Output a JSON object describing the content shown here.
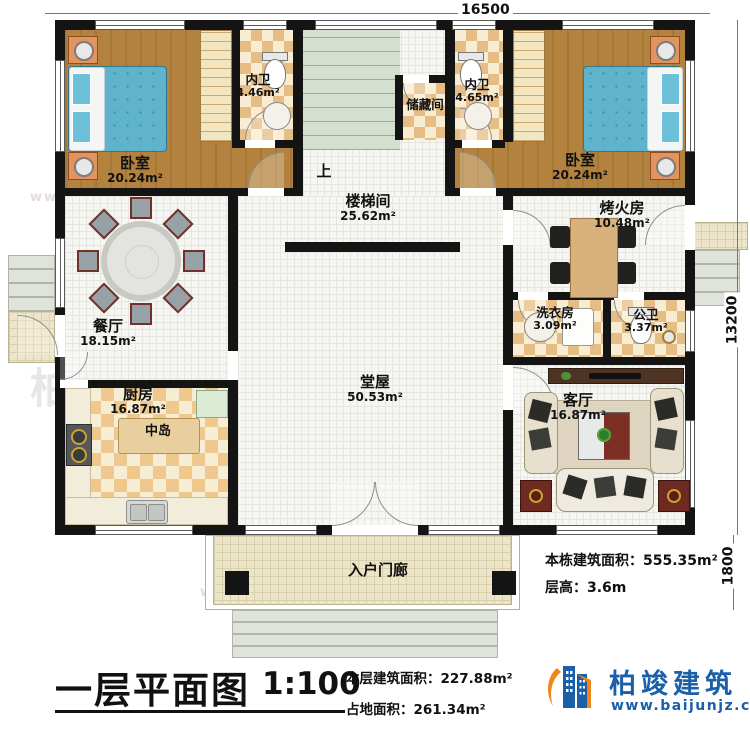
{
  "dimensions": {
    "top_width": "16500",
    "right_height": "13200",
    "porch_depth": "1800"
  },
  "rooms": [
    {
      "name": "卧室",
      "area": "20.24m²"
    },
    {
      "name": "内卫",
      "area": "4.46m²"
    },
    {
      "name": "储藏间",
      "area": ""
    },
    {
      "name": "楼梯间",
      "area": "25.62m²"
    },
    {
      "name": "内卫",
      "area": "4.65m²"
    },
    {
      "name": "卧室",
      "area": "20.24m²"
    },
    {
      "name": "餐厅",
      "area": "18.15m²"
    },
    {
      "name": "堂屋",
      "area": "50.53m²"
    },
    {
      "name": "烤火房",
      "area": "10.48m²"
    },
    {
      "name": "洗衣房",
      "area": "3.09m²"
    },
    {
      "name": "公卫",
      "area": "3.37m²"
    },
    {
      "name": "厨房",
      "area": "16.87m²"
    },
    {
      "name": "客厅",
      "area": "16.87m²"
    },
    {
      "name": "入户门廊",
      "area": ""
    }
  ],
  "labels": {
    "up": "上",
    "island": "中岛"
  },
  "info": {
    "building_total_label": "本栋建筑面积：",
    "building_total_value": "555.35m²",
    "floor_height_label": "层高：",
    "floor_height_value": "3.6m",
    "floor_area_label": "本层建筑面积：",
    "floor_area_value": "227.88m²",
    "footprint_label": "占地面积：",
    "footprint_value": "261.34m²"
  },
  "title": {
    "text": "一层平面图",
    "scale": "1:100"
  },
  "logo": {
    "company": "柏竣建筑",
    "website": "www.baijunjz.com",
    "blue": "#1a5fa8",
    "orange": "#f08519"
  },
  "watermark": {
    "text": "柏竣建筑",
    "subtext": "www.baijunjz.com"
  }
}
